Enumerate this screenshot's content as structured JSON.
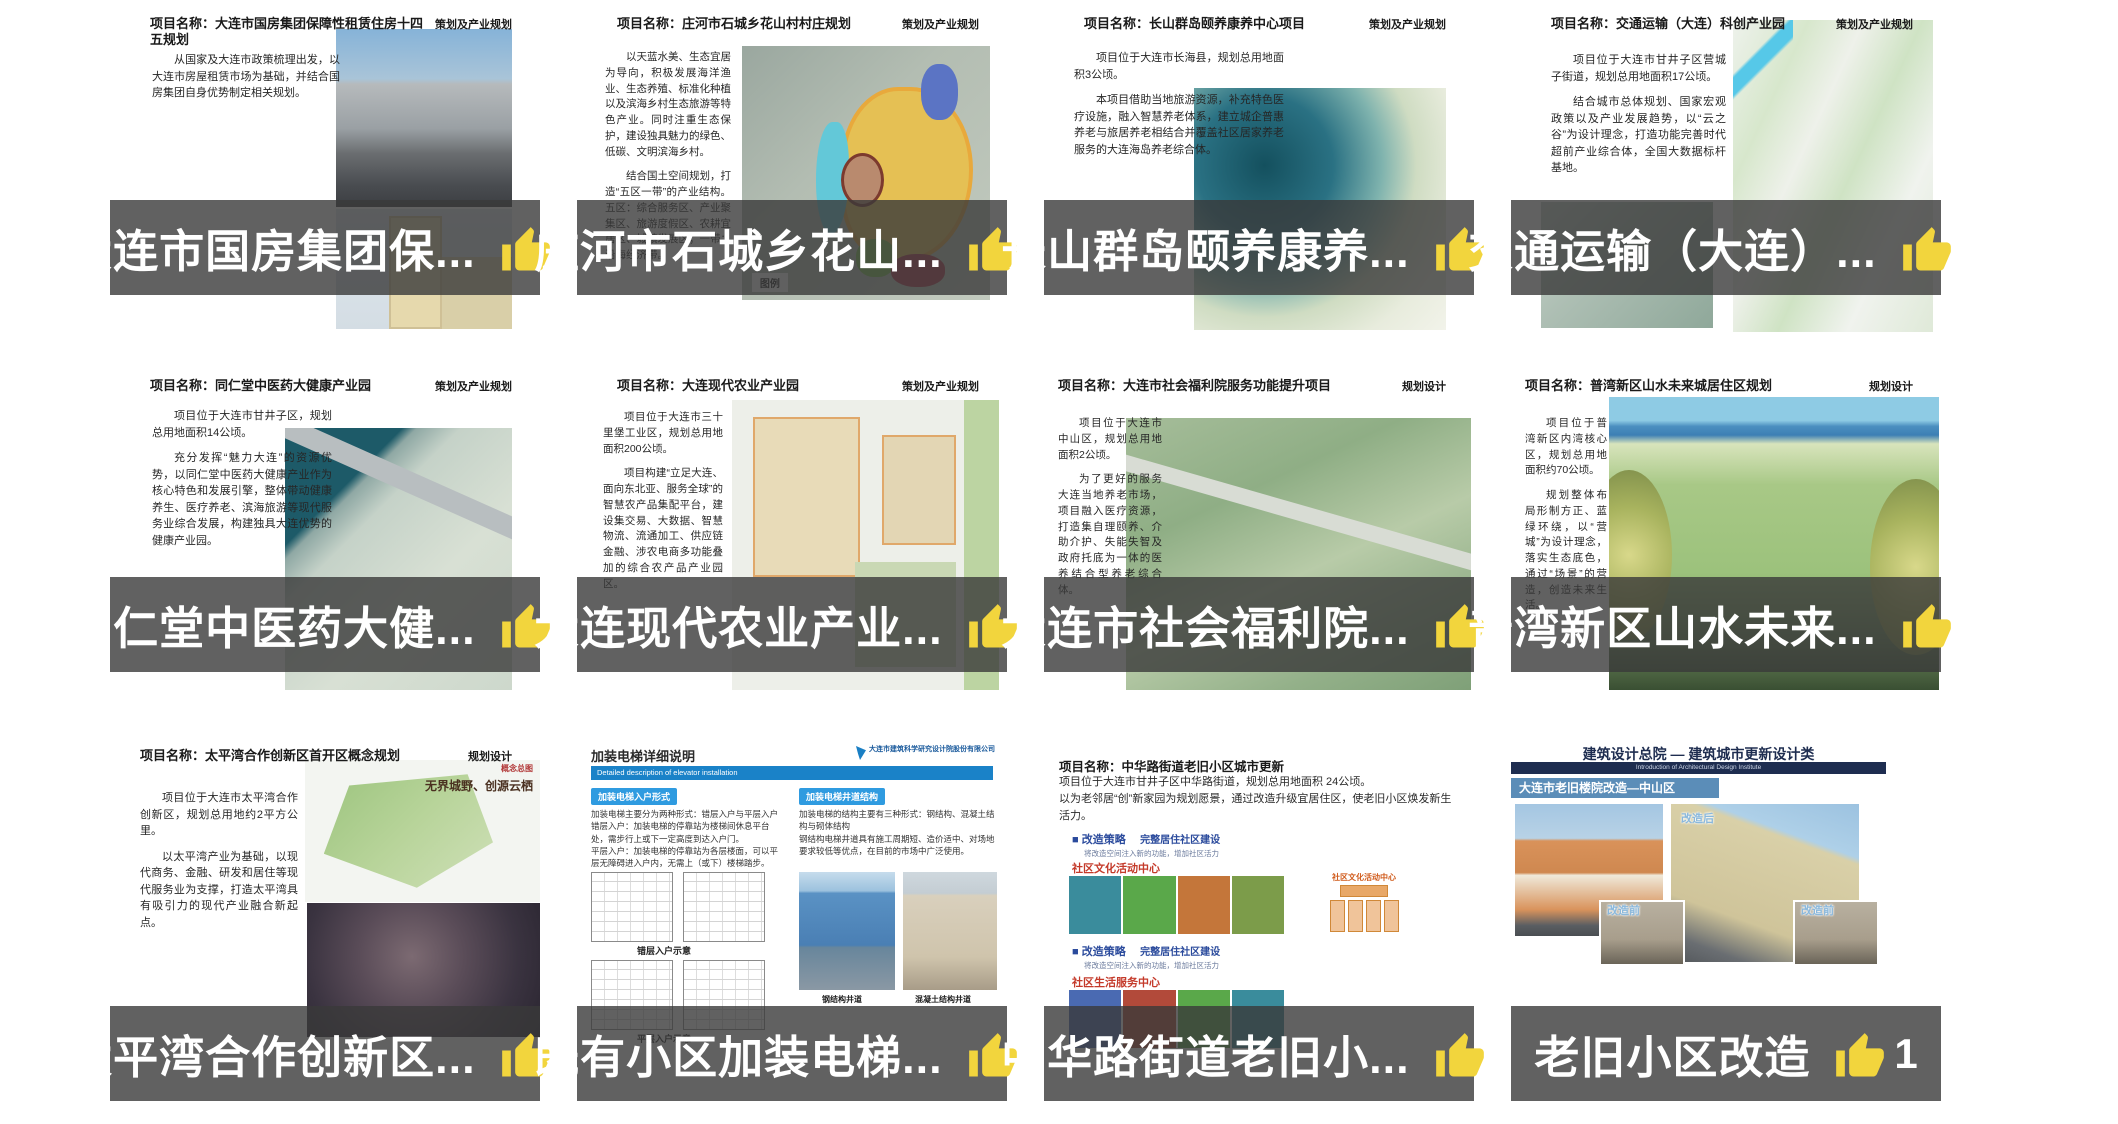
{
  "style": {
    "banner_overlay": "rgba(58,58,58,0.8)",
    "thumb_color": "#F2D53D",
    "banner_text_color": "#FFFFFF"
  },
  "cards": [
    {
      "banner": {
        "title": "大连市国房集团保...",
        "likes": "9"
      },
      "slide": {
        "title": "项目名称：大连市国房集团保障性租赁住房十四五规划",
        "corner": "策划及产业规划",
        "body": [
          "从国家及大连市政策梳理出发，以大连市房屋租赁市场为基础，并结合国房集团自身优势制定相关规划。"
        ]
      }
    },
    {
      "banner": {
        "title": "庄河市石城乡花山...",
        "likes": "2"
      },
      "slide": {
        "title": "项目名称：庄河市石城乡花山村村庄规划",
        "corner": "策划及产业规划",
        "body": [
          "以天蓝水美、生态宜居为导向，积极发展海洋渔业、生态养殖、标准化种植以及滨海乡村生态旅游等特色产业。同时注重生态保护，建设独具魅力的绿色、低碳、文明滨海乡村。",
          "结合国土空间规划，打造“五区一带”的产业结构。五区：综合服务区、产业聚集区、旅游度假区、农耕宜居区、城镇发展区；一带：沿海经济带。"
        ],
        "legend": "图例"
      }
    },
    {
      "banner": {
        "title": "长山群岛颐养康养...",
        "likes": "4"
      },
      "slide": {
        "title": "项目名称：长山群岛颐养康养中心项目",
        "corner": "策划及产业规划",
        "body": [
          "项目位于大连市长海县，规划总用地面积3公顷。",
          "本项目借助当地旅游资源，补充特色医疗设施，融入智慧养老体系，建立城企普惠养老与旅居养老相结合并覆盖社区居家养老服务的大连海岛养老综合体。"
        ]
      }
    },
    {
      "banner": {
        "title": "交通运输（大连）...",
        "likes": "3"
      },
      "slide": {
        "title": "项目名称：交通运输（大连）科创产业园",
        "corner": "策划及产业规划",
        "body": [
          "项目位于大连市甘井子区营城子街道，规划总用地面积17公顷。",
          "结合城市总体规划、国家宏观政策以及产业发展趋势，以“云之谷”为设计理念，打造功能完善时代超前产业综合体，全国大数据标杆基地。"
        ]
      }
    },
    {
      "banner": {
        "title": "同仁堂中医药大健...",
        "likes": "6"
      },
      "slide": {
        "title": "项目名称：同仁堂中医药大健康产业园",
        "corner": "策划及产业规划",
        "body": [
          "项目位于大连市甘井子区，规划总用地面积14公顷。",
          "充分发挥“魅力大连”的资源优势，以同仁堂中医药大健康产业作为核心特色和发展引擎，整体带动健康养生、医疗养老、滨海旅游等现代服务业综合发展，构建独具大连优势的健康产业园。"
        ]
      }
    },
    {
      "banner": {
        "title": "大连现代农业产业...",
        "likes": "3"
      },
      "slide": {
        "title": "项目名称：大连现代农业产业园",
        "corner": "策划及产业规划",
        "body": [
          "项目位于大连市三十里堡工业区，规划总用地面积200公顷。",
          "项目构建“立足大连、面向东北亚、服务全球”的智慧农产品集配平台，建设集交易、大数据、智慧物流、流通加工、供应链金融、涉农电商多功能叠加的综合农产品产业园区。"
        ]
      }
    },
    {
      "banner": {
        "title": "大连市社会福利院...",
        "likes": "2"
      },
      "slide": {
        "title": "项目名称：大连市社会福利院服务功能提升项目",
        "corner": "规划设计",
        "body": [
          "项目位于大连市中山区，规划总用地面积2公顷。",
          "为了更好的服务大连当地养老市场，项目融入医疗资源，打造集自理颐养、介助介护、失能失智及政府托底为一体的医养结合型养老综合体。"
        ]
      }
    },
    {
      "banner": {
        "title": "普湾新区山水未来...",
        "likes": "1"
      },
      "slide": {
        "title": "项目名称：普湾新区山水未来城居住区规划",
        "corner": "规划设计",
        "body": [
          "项目位于普湾新区内湾核心区，规划总用地面积约70公顷。",
          "规划整体布局形制方正、蓝绿环绕，以“营城”为设计理念，落实生态底色，通过“场景”的营造，创造未来生活。"
        ]
      }
    },
    {
      "banner": {
        "title": "太平湾合作创新区...",
        "likes": "2"
      },
      "slide": {
        "title": "项目名称：太平湾合作创新区首开区概念规划",
        "corner": "规划设计",
        "body": [
          "项目位于大连市太平湾合作创新区，规划总用地约2平方公里。",
          "以太平湾产业为基础，以现代商务、金融、研发和居住等现代服务业为支撑，打造太平湾具有吸引力的现代产业融合新起点。"
        ],
        "map_tag": "概念总图",
        "map_title": "无界城野、创源云栖"
      }
    },
    {
      "banner": {
        "title": "既有小区加装电梯...",
        "likes": "3"
      },
      "slide": {
        "heading": "加装电梯详细说明",
        "subheading_en": "Detailed description of elevator installation",
        "company": "大连市建筑科学研究设计院股份有限公司",
        "left_chip": "加装电梯入户形式",
        "left_text_1": "加装电梯主要分为两种形式：错层入户与平层入户",
        "left_text_2": "错层入户：加装电梯的停靠站为楼梯间休息平台处，需步行上或下一定高度到达入户门。",
        "left_text_3": "平层入户：加装电梯的停靠站为各层楼面，可以平层无障碍进入户内，无需上（或下）楼梯踏步。",
        "caption_1": "错层入户示意",
        "caption_2": "平层入户示意",
        "right_chip": "加装电梯井道结构",
        "right_text_1": "加装电梯的结构主要有三种形式：钢结构、混凝土结构与砌体结构",
        "right_text_2": "钢结构电梯井道具有施工周期短、造价适中、对场地要求较低等优点，在目前的市场中广泛使用。",
        "photo_caption_1": "钢结构井道",
        "photo_caption_2": "混凝土结构井道"
      }
    },
    {
      "banner": {
        "title": "中华路街道老旧小...",
        "likes": "2"
      },
      "slide": {
        "title": "项目名称：中华路街道老旧小区城市更新",
        "body": [
          "项目位于大连市甘井子区中华路街道，规划总用地面积 24公顷。",
          "以为老邻居“创”新家园为规划愿景，通过改造升级宜居住区，使老旧小区焕发新生活力。"
        ],
        "section_heading": "■ 改造策略",
        "section_sub": "完整居住社区建设",
        "section_note": "将改造空间注入新的功能，增加社区活力",
        "label_culture": "社区文化活动中心",
        "chart_title": "社区文化活动中心",
        "label_life": "社区生活服务中心"
      }
    },
    {
      "banner": {
        "title": "老旧小区改造",
        "likes": "1"
      },
      "slide": {
        "header": "建筑设计总院 — 建筑城市更新设计类",
        "header_en": "Introduction of Architectural Design Institute",
        "bar": "大连市老旧楼院改造—中山区",
        "label_after": "改造后",
        "label_before": "改造前"
      }
    }
  ]
}
